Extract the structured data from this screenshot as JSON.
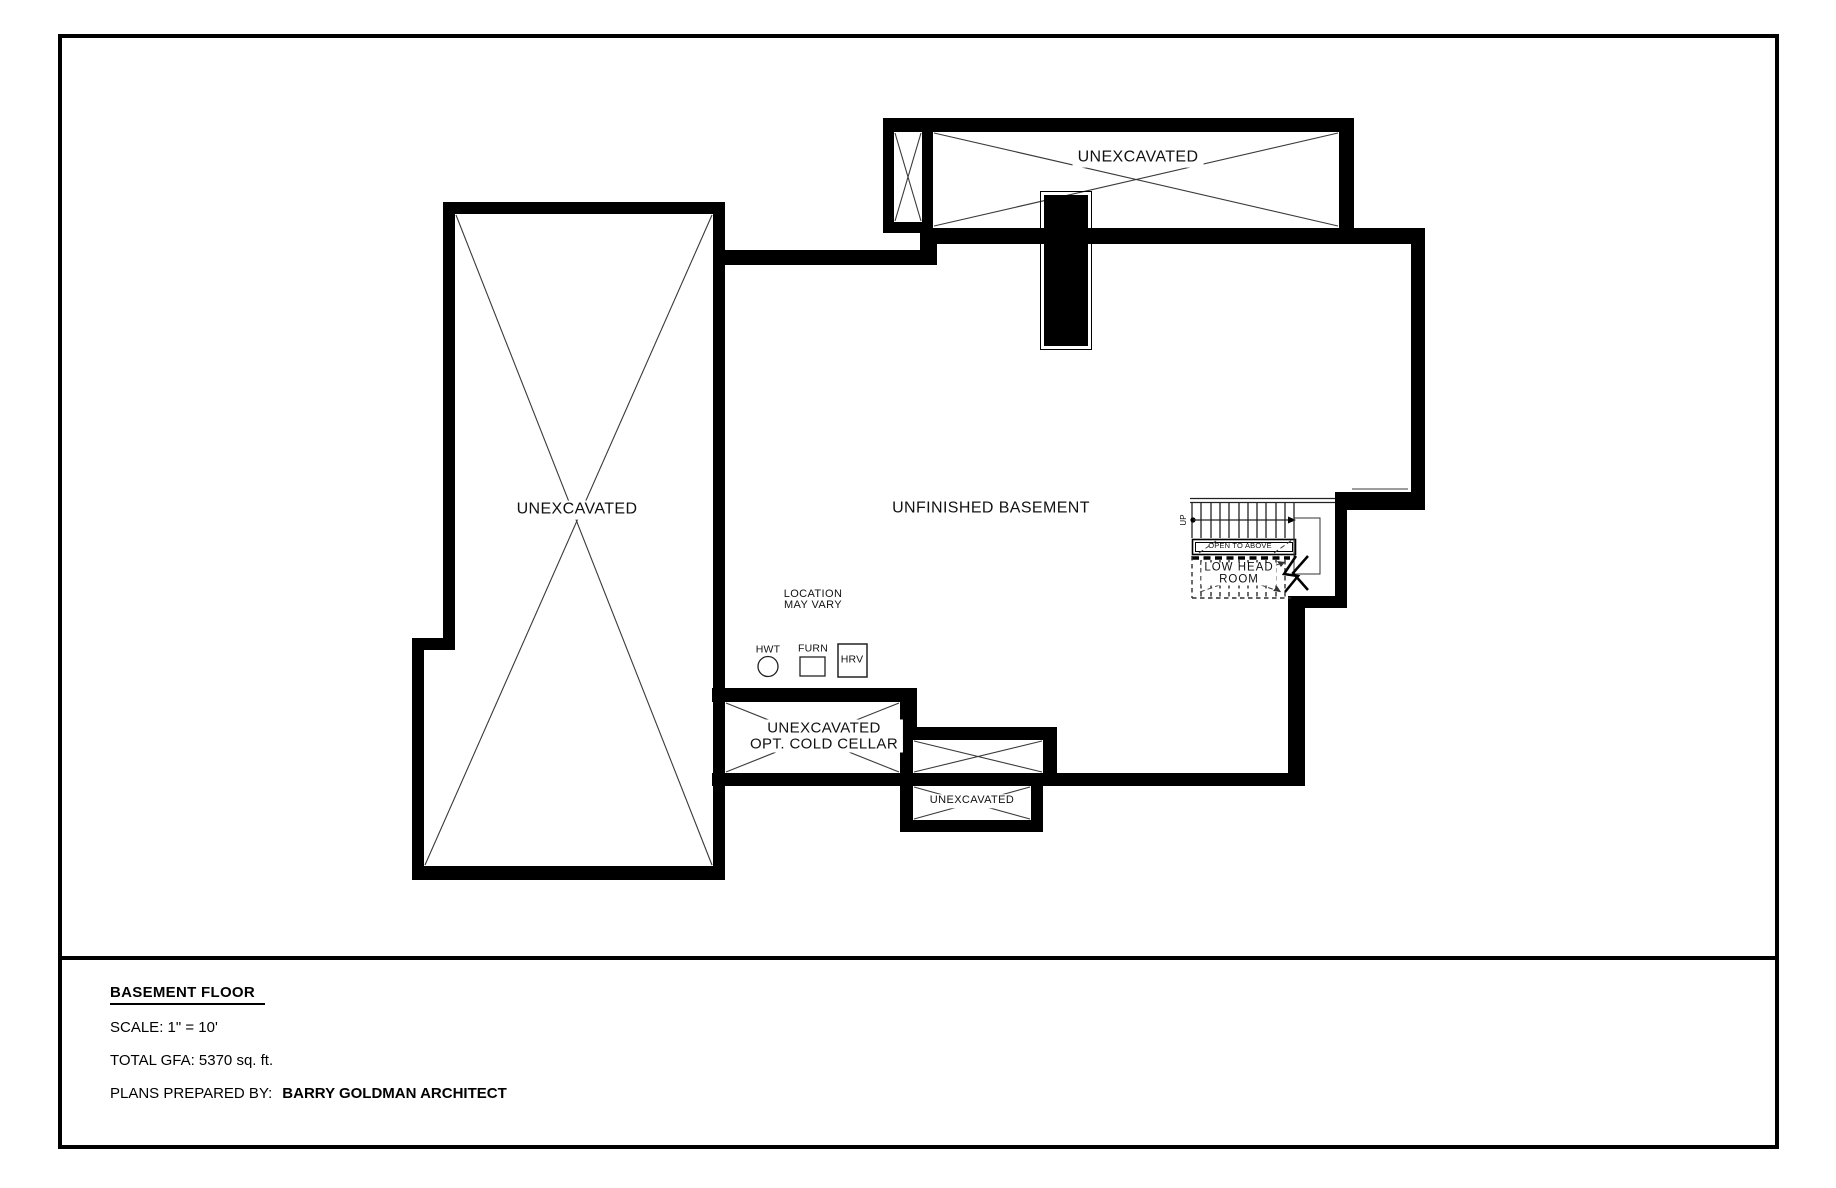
{
  "sheet": {
    "title": "BASEMENT FLOOR",
    "scale": "SCALE: 1\" = 10'",
    "gfa": "TOTAL GFA: 5370 sq. ft.",
    "prepared_by_label": "PLANS PREPARED BY:",
    "prepared_by_name": "BARRY GOLDMAN ARCHITECT"
  },
  "plan": {
    "rooms": {
      "left_unexcavated": "UNEXCAVATED",
      "top_unexcavated": "UNEXCAVATED",
      "main_room": "UNFINISHED BASEMENT",
      "cold_cellar_line1": "UNEXCAVATED",
      "cold_cellar_line2": "OPT. COLD CELLAR",
      "bottom_unexcavated": "UNEXCAVATED"
    },
    "stairs": {
      "up": "UP",
      "open_to_above": "OPEN TO ABOVE",
      "low_head_line1": "LOW HEAD",
      "low_head_line2": "ROOM"
    },
    "equipment": {
      "note_line1": "LOCATION",
      "note_line2": "MAY VARY",
      "hwt": "HWT",
      "furn": "FURN",
      "hrv": "HRV"
    }
  },
  "colors": {
    "ink": "#000000",
    "paper": "#ffffff",
    "thin_line": "#3a3a3a"
  }
}
